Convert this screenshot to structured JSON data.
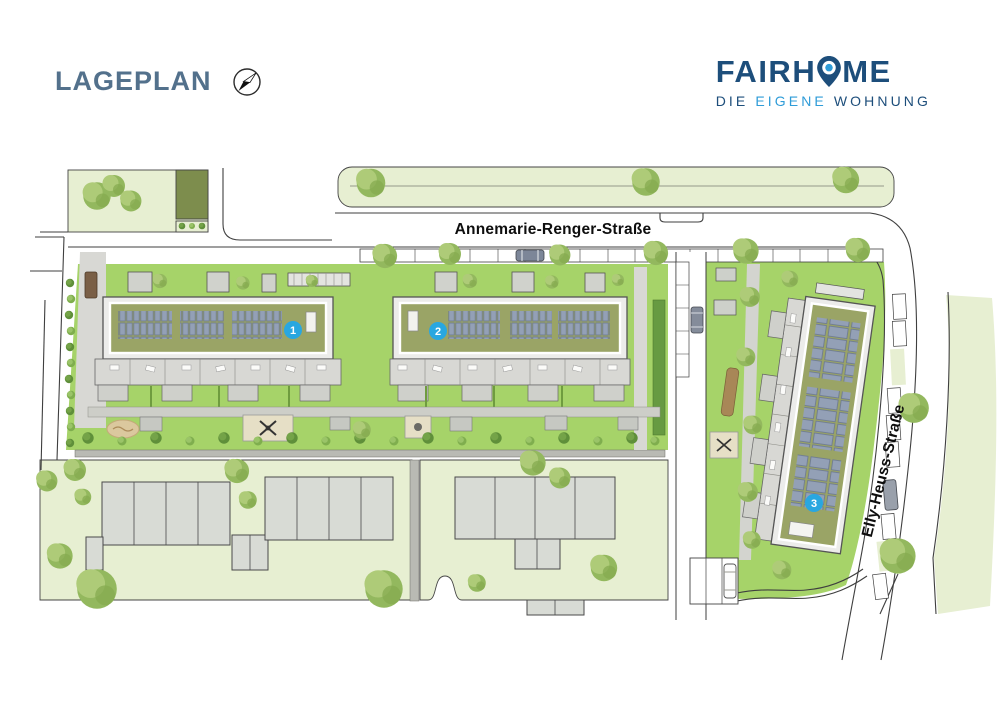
{
  "header": {
    "title": "LAGEPLAN"
  },
  "logo": {
    "brand_part1": "FAIRH",
    "brand_part2": "ME",
    "tagline": {
      "word1": "DIE",
      "word2": "EIGENE",
      "word3": "WOHNUNG"
    }
  },
  "map": {
    "streets": [
      {
        "name": "Annemarie-Renger-Straße"
      },
      {
        "name": "Elly-Heuss-Straße"
      }
    ],
    "buildings": [
      {
        "number": "1"
      },
      {
        "number": "2"
      },
      {
        "number": "3"
      }
    ]
  },
  "icons": {
    "compass": "compass-icon",
    "pin": "location-pin-icon"
  },
  "colors": {
    "accent_blue": "#29a7e0",
    "brand_dark_blue": "#1d4e7b",
    "brand_light_blue": "#2f9cd8",
    "title_slate": "#53718c",
    "lawn_green": "#a6d369",
    "pale_green": "#e7efd2",
    "roof_olive": "#9aa466",
    "solar_panel": "#93a0b6",
    "building_gray": "#d8dbd5",
    "terrace_gray": "#d8d8d4",
    "line_dark": "#3f3f3f"
  }
}
